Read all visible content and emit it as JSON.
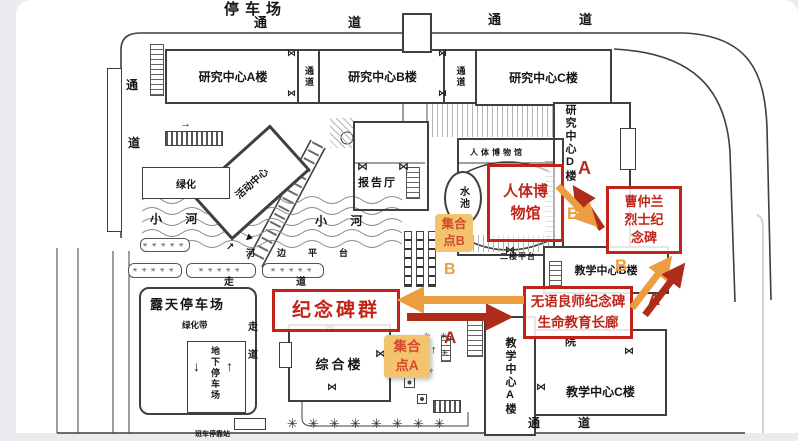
{
  "map_title": "停车场",
  "colors": {
    "page_bg": "#e9ebef",
    "line": "#3f3f3f",
    "red_box": "#c02418",
    "route_a": "#b02c1a",
    "route_b": "#ec9d3f",
    "assembly_bg": "#f4c36d",
    "assembly_text": "#d24a2e"
  },
  "roads": {
    "tong": "通",
    "dao": "道"
  },
  "buildings": {
    "research_a": "研究中心A楼",
    "research_b": "研究中心B楼",
    "research_c": "研究中心C楼",
    "research_d": "研究中心D楼",
    "passage_vertical": "通道",
    "lecture_hall": "报告厅",
    "museum_label": "人体博物馆",
    "activity_center": "活动中心",
    "comprehensive": "综合楼",
    "teaching_a": "教学中心A楼",
    "teaching_b": "教学中心B楼",
    "teaching_c": "教学中心C楼",
    "hospital_char": "院"
  },
  "areas": {
    "pool": "水池",
    "river": "小 河",
    "riverside_platform": "河边平台",
    "greenery": "绿化",
    "greenery_belt": "绿化带",
    "open_parking": "露天停车场",
    "underground_parking": "地下停车场",
    "walk": "走",
    "walk_road": "道",
    "second_floor_platform": "二楼平台",
    "bus_stop": "班车停靠站"
  },
  "callouts": {
    "museum_line1": "人体博",
    "museum_line2": "物馆",
    "cao_line1": "曹仲兰",
    "cao_line2": "烈士纪",
    "cao_line3": "念碑",
    "monument_group": "纪念碑群",
    "mentor_line1": "无语良师纪念碑",
    "mentor_line2": "生命教育长廊"
  },
  "assembly": {
    "b_line1": "集合",
    "b_line2": "点B",
    "a_line1": "集合",
    "a_line2": "点A"
  },
  "markers": {
    "a": "A",
    "b": "B"
  },
  "glyphs": {
    "tree": "✳",
    "tree_row": "✳✳✳✳✳",
    "door": "⋈",
    "arrow_down": "↓",
    "arrow_up": "↑",
    "arrow_right": "→",
    "arrow_upright": "↗",
    "arrow_solid": "▲"
  }
}
